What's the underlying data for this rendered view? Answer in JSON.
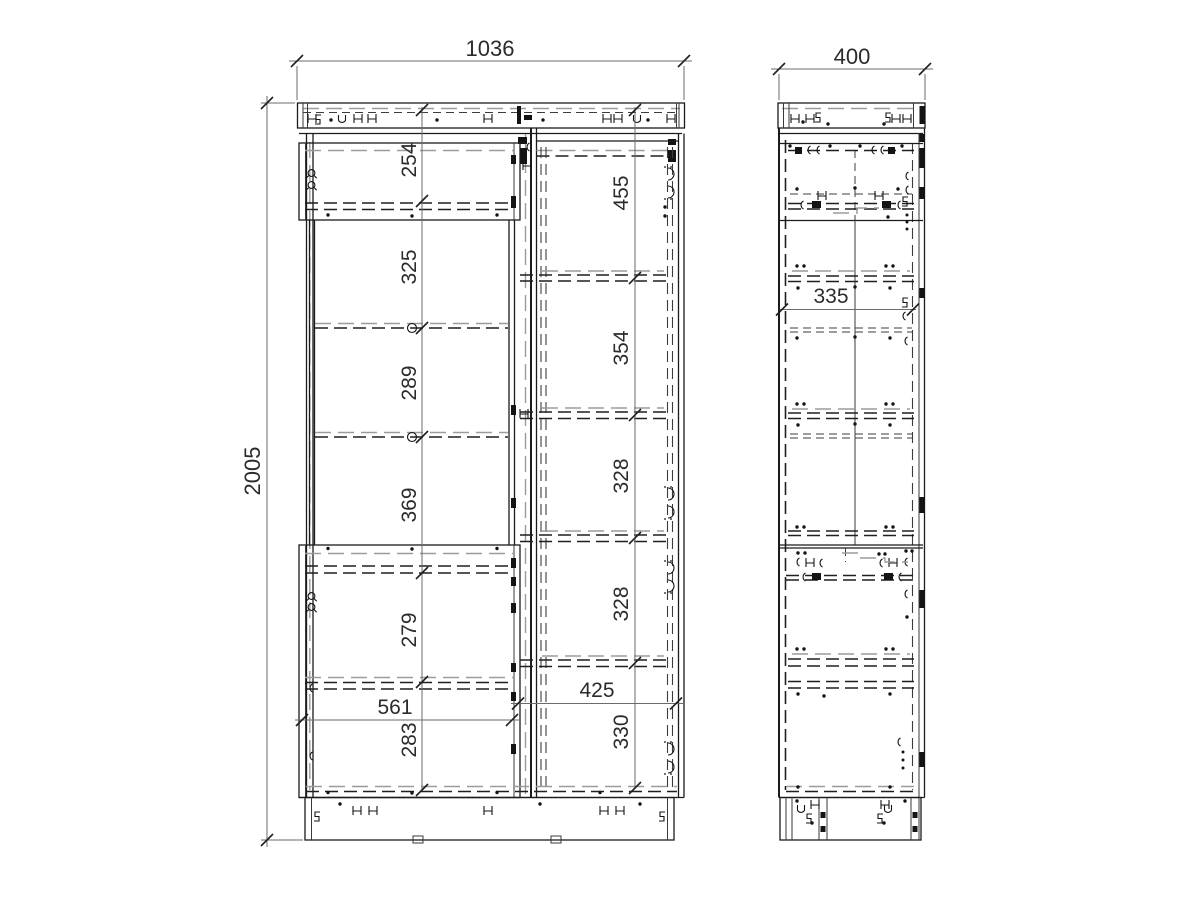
{
  "drawing": {
    "name": "Wardrobe cabinet assembly drawing - front and side orthographic views",
    "front_view": {
      "overall_width": "1036",
      "overall_height": "2005",
      "left_column": {
        "section_heights": [
          "254",
          "325",
          "289",
          "369",
          "279",
          "283"
        ],
        "inner_width": "561"
      },
      "right_column": {
        "section_heights": [
          "455",
          "354",
          "328",
          "328",
          "330"
        ],
        "inner_width": "425"
      }
    },
    "side_view": {
      "overall_depth": "400",
      "inner_depth": "335"
    },
    "colors": {
      "line": "#1b1b1b",
      "hidden_line": "#9b9b9b",
      "background": "#ffffff"
    }
  }
}
